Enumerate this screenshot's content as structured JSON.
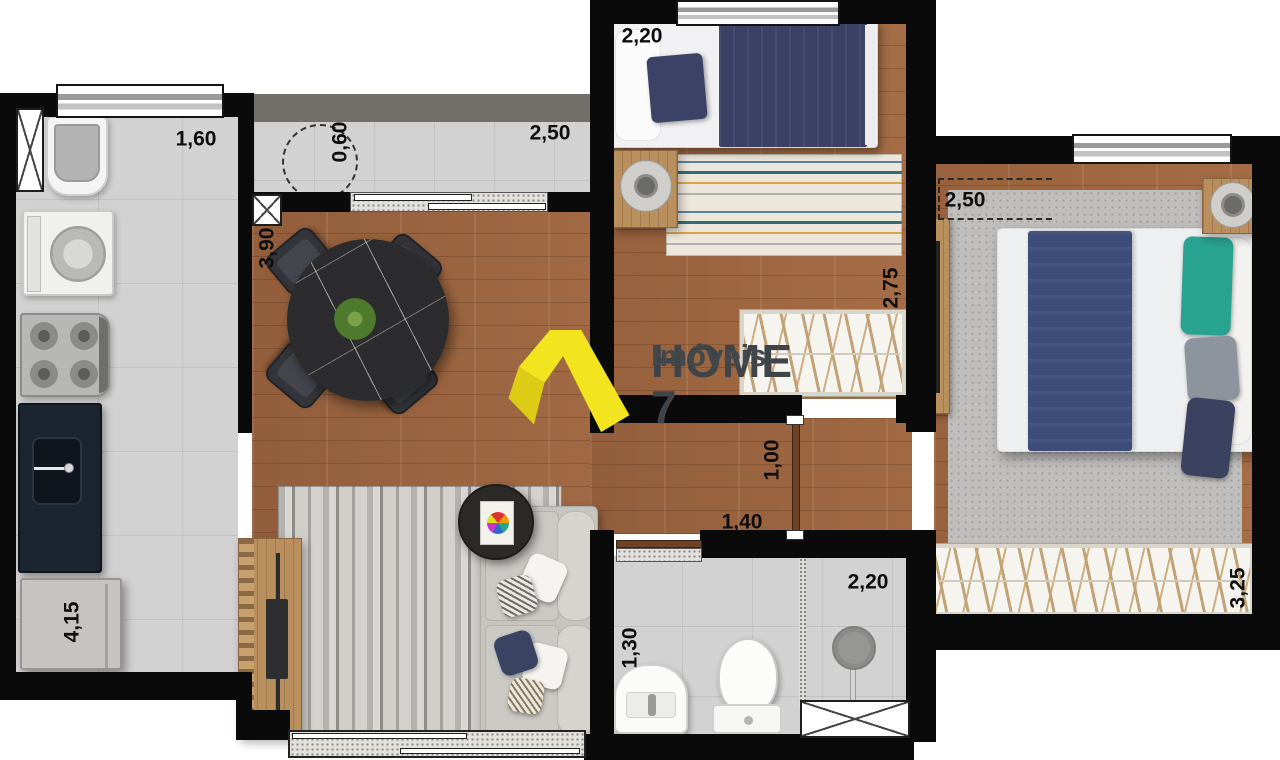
{
  "brand": {
    "title": "HOME 7",
    "subtitle": "Imóveis",
    "mark_color": "#f2e41e",
    "text_color": "#3f4449"
  },
  "dimensions": {
    "service_width": "1,60",
    "balcony_depth": "0,60",
    "balcony_width": "2,50",
    "dining_length": "3,90",
    "bedroom1_width": "2,20",
    "bedroom1_length": "2,75",
    "master_width": "2,50",
    "master_length": "3,25",
    "hall_opening": "1,00",
    "hall_width": "1,40",
    "bathroom_width": "1,30",
    "bathroom_length": "2,20",
    "kitchen_length": "4,15"
  },
  "palette": {
    "wall": "#0a0a0a",
    "wood_floor": "#9c6743",
    "tile_floor": "#d2d2d2",
    "navy_bedding": "#3a4164",
    "teal_pillow": "#28a392",
    "counter": "#1c2430"
  }
}
